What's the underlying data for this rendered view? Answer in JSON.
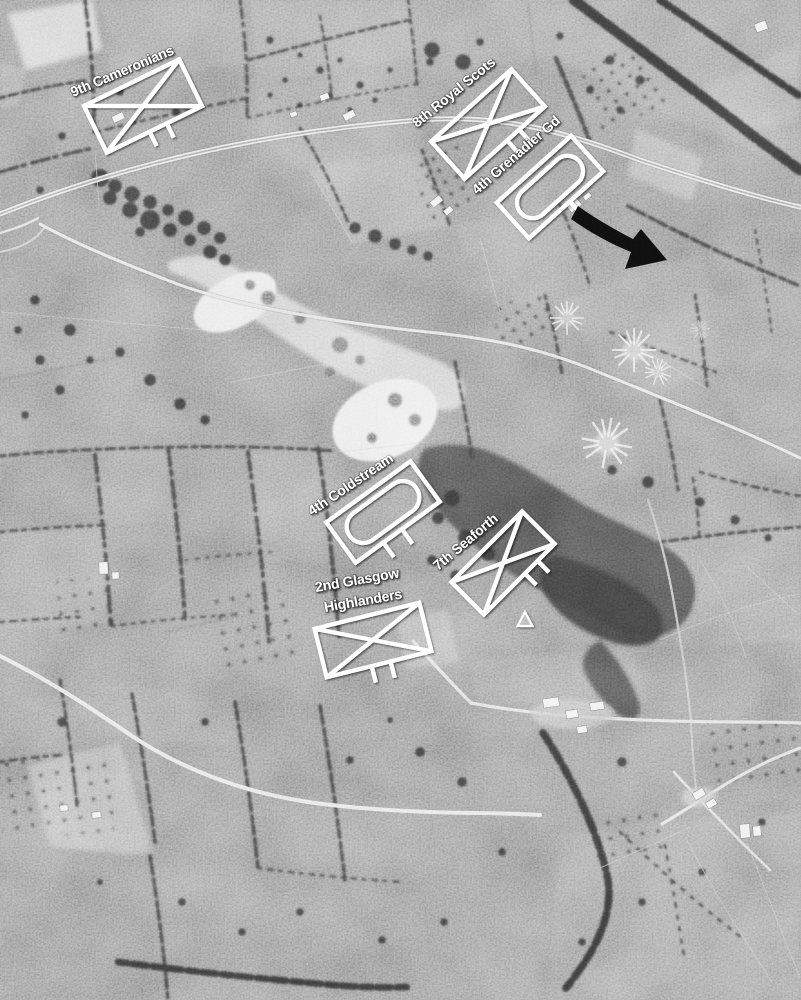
{
  "photo": {
    "kind": "black-and-white aerial reconnaissance photograph",
    "terrain": "bocage farmland with railway, roads, quarry, woods, orchards and shell bursts"
  },
  "overlay": {
    "style": {
      "symbol_color": "#ffffff",
      "label_color": "#ffffff",
      "arrow_color": "#0b0b0b"
    },
    "units": [
      {
        "id": "9th-cameronians",
        "label": "9th Cameronians",
        "symbol": "infantry",
        "rect": {
          "cx": 143,
          "cy": 106,
          "w": 106,
          "h": 52,
          "rot": -26
        },
        "legs": {
          "at": [
            0.45,
            0.63
          ],
          "len": 16
        },
        "label_lines": [
          {
            "text": "9th Cameronians",
            "x": 73,
            "y": 97,
            "rot": -23
          }
        ]
      },
      {
        "id": "8th-royal-scots",
        "label": "8th Royal Scots",
        "symbol": "infantry",
        "rect": {
          "cx": 488,
          "cy": 124,
          "w": 108,
          "h": 50,
          "rot": -42
        },
        "legs": {
          "at": [
            0.53,
            0.68
          ],
          "len": 16
        },
        "label_lines": [
          {
            "text": "8th Royal Scots",
            "x": 417,
            "y": 128,
            "rot": -39
          }
        ]
      },
      {
        "id": "4th-grenadier-gd",
        "label": "4th Grenadier Gd",
        "symbol": "armoured",
        "rect": {
          "cx": 550,
          "cy": 187,
          "w": 100,
          "h": 48,
          "rot": -42
        },
        "legs": {
          "at": [
            0.55
          ],
          "len": 15
        },
        "label_lines": [
          {
            "text": "4th Grenadier Gd",
            "x": 477,
            "y": 195,
            "rot": -41
          }
        ]
      },
      {
        "id": "4th-coldstream",
        "label": "4th Coldstream",
        "symbol": "armoured",
        "rect": {
          "cx": 383,
          "cy": 512,
          "w": 104,
          "h": 50,
          "rot": -36
        },
        "legs": {
          "at": [
            0.33,
            0.55
          ],
          "len": 18
        },
        "label_lines": [
          {
            "text": "4th Coldstream",
            "x": 312,
            "y": 516,
            "rot": -34
          }
        ]
      },
      {
        "id": "7th-seaforth",
        "label": "7th Seaforth",
        "symbol": "infantry",
        "rect": {
          "cx": 503,
          "cy": 563,
          "w": 100,
          "h": 46,
          "rot": -45
        },
        "legs": {
          "at": [
            0.58,
            0.76
          ],
          "len": 16
        },
        "label_lines": [
          {
            "text": "7th Seaforth",
            "x": 438,
            "y": 571,
            "rot": -40
          }
        ]
      },
      {
        "id": "2nd-glasgow-highlanders",
        "label": "2nd Glasgow Highlanders",
        "symbol": "infantry",
        "rect": {
          "cx": 373,
          "cy": 640,
          "w": 108,
          "h": 50,
          "rot": -14
        },
        "legs": {
          "at": [
            0.43,
            0.61
          ],
          "len": 17
        },
        "label_lines": [
          {
            "text": "2nd Glasgow",
            "x": 316,
            "y": 592,
            "rot": -10
          },
          {
            "text": "Highlanders",
            "x": 325,
            "y": 612,
            "rot": -10
          }
        ]
      }
    ],
    "markers": {
      "attack_arrow": {
        "description": "black curved arrow pointing down-right",
        "from": [
          577,
          210
        ],
        "tip": [
          667,
          260
        ]
      },
      "triangle": {
        "description": "small white triangle marker",
        "x": 525,
        "y": 621
      }
    }
  }
}
